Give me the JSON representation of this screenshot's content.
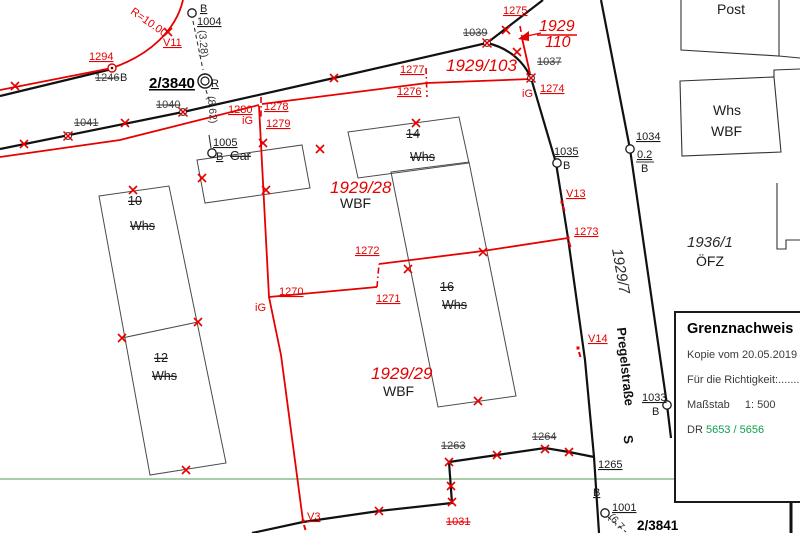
{
  "colors": {
    "red": "#e60000",
    "black": "#1a1a1a",
    "deleted_label": "#3f3f3f",
    "green_line": "#8fbc8f",
    "dr_green": "#10a050",
    "building_outline": "#4a4a4a"
  },
  "info_box": {
    "title": "Grenznachweis",
    "copy_line": "Kopie vom 20.05.2019",
    "correctness_line": "Für die Richtigkeit:........",
    "scale_label": "Maßstab",
    "scale_value": "1: 500",
    "dr_label": "DR",
    "dr_value": "5653 / 5656"
  },
  "map": {
    "labels": [
      {
        "t": "V11",
        "x": 163,
        "y": 46,
        "c": "red"
      },
      {
        "t": "1294",
        "x": 89,
        "y": 60,
        "c": "red"
      },
      {
        "t": "1280",
        "x": 228,
        "y": 113,
        "c": "red"
      },
      {
        "t": "1278",
        "x": 264,
        "y": 110,
        "c": "red"
      },
      {
        "t": "1279",
        "x": 266,
        "y": 127,
        "c": "red"
      },
      {
        "t": "1277",
        "x": 400,
        "y": 73,
        "c": "red"
      },
      {
        "t": "1276",
        "x": 397,
        "y": 95,
        "c": "red"
      },
      {
        "t": "1275",
        "x": 503,
        "y": 14,
        "c": "red"
      },
      {
        "t": "1274",
        "x": 540,
        "y": 92,
        "c": "red"
      },
      {
        "t": "1270",
        "x": 279,
        "y": 295,
        "c": "red"
      },
      {
        "t": "1271",
        "x": 376,
        "y": 302,
        "c": "red"
      },
      {
        "t": "1272",
        "x": 355,
        "y": 254,
        "c": "red"
      },
      {
        "t": "1273",
        "x": 574,
        "y": 235,
        "c": "red"
      },
      {
        "t": "V13",
        "x": 566,
        "y": 197,
        "c": "red"
      },
      {
        "t": "V14",
        "x": 588,
        "y": 342,
        "c": "red"
      },
      {
        "t": "V3",
        "x": 307,
        "y": 520,
        "c": "red"
      },
      {
        "t": "iG",
        "x": 242,
        "y": 124,
        "c": "redp"
      },
      {
        "t": "iG",
        "x": 255,
        "y": 311,
        "c": "redp"
      },
      {
        "t": "iG",
        "x": 522,
        "y": 97,
        "c": "redp"
      },
      {
        "t": "1246",
        "x": 95,
        "y": 81,
        "c": "del"
      },
      {
        "t": "1040",
        "x": 156,
        "y": 108,
        "c": "del"
      },
      {
        "t": "1041",
        "x": 74,
        "y": 126,
        "c": "del"
      },
      {
        "t": "1039",
        "x": 463,
        "y": 36,
        "c": "del"
      },
      {
        "t": "1037",
        "x": 537,
        "y": 65,
        "c": "del"
      },
      {
        "t": "1263",
        "x": 441,
        "y": 449,
        "c": "del"
      },
      {
        "t": "1264",
        "x": 532,
        "y": 440,
        "c": "del"
      },
      {
        "t": "1031",
        "x": 446,
        "y": 525,
        "c": "delred"
      },
      {
        "t": "B",
        "x": 200,
        "y": 12,
        "c": "blk"
      },
      {
        "t": "1004",
        "x": 197,
        "y": 25,
        "c": "blk"
      },
      {
        "t": "1005",
        "x": 213,
        "y": 146,
        "c": "blk"
      },
      {
        "t": "B",
        "x": 216,
        "y": 160,
        "c": "blk"
      },
      {
        "t": "1034",
        "x": 636,
        "y": 140,
        "c": "blk"
      },
      {
        "t": "0.2",
        "x": 637,
        "y": 158,
        "c": "blk"
      },
      {
        "t": "B",
        "x": 641,
        "y": 172,
        "c": "blkp"
      },
      {
        "t": "1035",
        "x": 554,
        "y": 155,
        "c": "blk"
      },
      {
        "t": "B",
        "x": 563,
        "y": 169,
        "c": "blkp"
      },
      {
        "t": "1033",
        "x": 642,
        "y": 401,
        "c": "blk"
      },
      {
        "t": "B",
        "x": 652,
        "y": 415,
        "c": "blkp"
      },
      {
        "t": "B",
        "x": 593,
        "y": 496,
        "c": "blk"
      },
      {
        "t": "1001",
        "x": 612,
        "y": 511,
        "c": "blk"
      },
      {
        "t": "1265",
        "x": 598,
        "y": 468,
        "c": "blk"
      },
      {
        "t": "R",
        "x": 211,
        "y": 87,
        "c": "blk"
      },
      {
        "t": "B",
        "x": 120,
        "y": 81,
        "c": "blkp"
      },
      {
        "t": "2/3840",
        "x": 149,
        "y": 88,
        "c": "b15"
      },
      {
        "t": "2/3841",
        "x": 637,
        "y": 530,
        "c": "b14b"
      },
      {
        "t": "1929/103",
        "x": 446,
        "y": 71,
        "c": "pr"
      },
      {
        "t": "1929/28",
        "x": 330,
        "y": 193,
        "c": "pr"
      },
      {
        "t": "1929/29",
        "x": 371,
        "y": 379,
        "c": "pr"
      },
      {
        "t": "1929",
        "x": 539,
        "y": 31,
        "c": "pr2"
      },
      {
        "t": "110",
        "x": 545,
        "y": 47,
        "c": "pr2"
      },
      {
        "t": "1936/1",
        "x": 687,
        "y": 247,
        "c": "pb"
      },
      {
        "t": "1929/7",
        "x": 616,
        "y": 272,
        "c": "pb",
        "r": 80,
        "a": "m"
      },
      {
        "t": "Post",
        "x": 717,
        "y": 14,
        "c": "nm"
      },
      {
        "t": "Whs",
        "x": 713,
        "y": 115,
        "c": "nm"
      },
      {
        "t": "WBF",
        "x": 711,
        "y": 136,
        "c": "nm"
      },
      {
        "t": "ÖFZ",
        "x": 696,
        "y": 266,
        "c": "nm"
      },
      {
        "t": "WBF",
        "x": 340,
        "y": 208,
        "c": "nm"
      },
      {
        "t": "WBF",
        "x": 383,
        "y": 396,
        "c": "nm"
      },
      {
        "t": "Pregelstraße",
        "x": 621,
        "y": 367,
        "c": "st",
        "r": 84,
        "a": "m"
      },
      {
        "t": "S",
        "x": 624,
        "y": 440,
        "c": "st",
        "r": 84,
        "a": "m"
      },
      {
        "t": "10",
        "x": 128,
        "y": 205,
        "c": "bld"
      },
      {
        "t": "Whs",
        "x": 130,
        "y": 230,
        "c": "bld"
      },
      {
        "t": "12",
        "x": 154,
        "y": 362,
        "c": "bld"
      },
      {
        "t": "Whs",
        "x": 152,
        "y": 380,
        "c": "bld"
      },
      {
        "t": "14",
        "x": 406,
        "y": 138,
        "c": "bld"
      },
      {
        "t": "Whs",
        "x": 410,
        "y": 161,
        "c": "bld"
      },
      {
        "t": "16",
        "x": 440,
        "y": 291,
        "c": "bld"
      },
      {
        "t": "Whs",
        "x": 442,
        "y": 309,
        "c": "bld"
      },
      {
        "t": "Gar",
        "x": 230,
        "y": 160,
        "c": "bld"
      },
      {
        "t": "(3.28)",
        "x": 200,
        "y": 44,
        "c": "ms",
        "r": 85,
        "a": "m"
      },
      {
        "t": "(8.62)",
        "x": 209,
        "y": 110,
        "c": "ms",
        "r": 85,
        "a": "m"
      },
      {
        "t": "(6.7",
        "x": 614,
        "y": 524,
        "c": "ms",
        "r": 48,
        "a": "m"
      },
      {
        "t": "R=10.00",
        "x": 147,
        "y": 25,
        "c": "rm",
        "r": 35,
        "a": "m"
      }
    ]
  }
}
